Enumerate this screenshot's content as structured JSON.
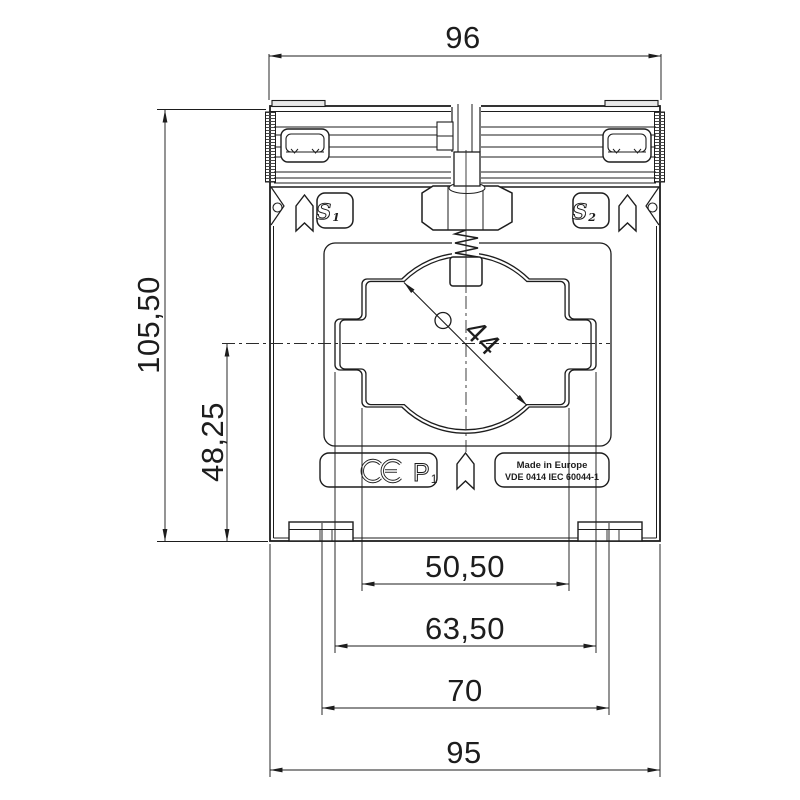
{
  "drawing": {
    "kind": "technical dimension drawing",
    "subject": "current transformer front view"
  },
  "dimensions": {
    "top_width": "96",
    "overall_height": "105,50",
    "axis_height": "48,25",
    "aperture_diameter": "44",
    "window_inner_width": "50,50",
    "window_outer_width": "63,50",
    "mounting_spacing": "70",
    "base_width": "95"
  },
  "labels": {
    "s1": {
      "letter": "S",
      "sub": "1"
    },
    "s2": {
      "letter": "S",
      "sub": "2"
    },
    "p1": {
      "letter": "P",
      "sub": "1"
    },
    "ce": "CE",
    "made_in": "Made in Europe",
    "standard": "VDE 0414 IEC 60044-1"
  },
  "colors": {
    "line": "#1d1d1d",
    "background": "#ffffff"
  }
}
